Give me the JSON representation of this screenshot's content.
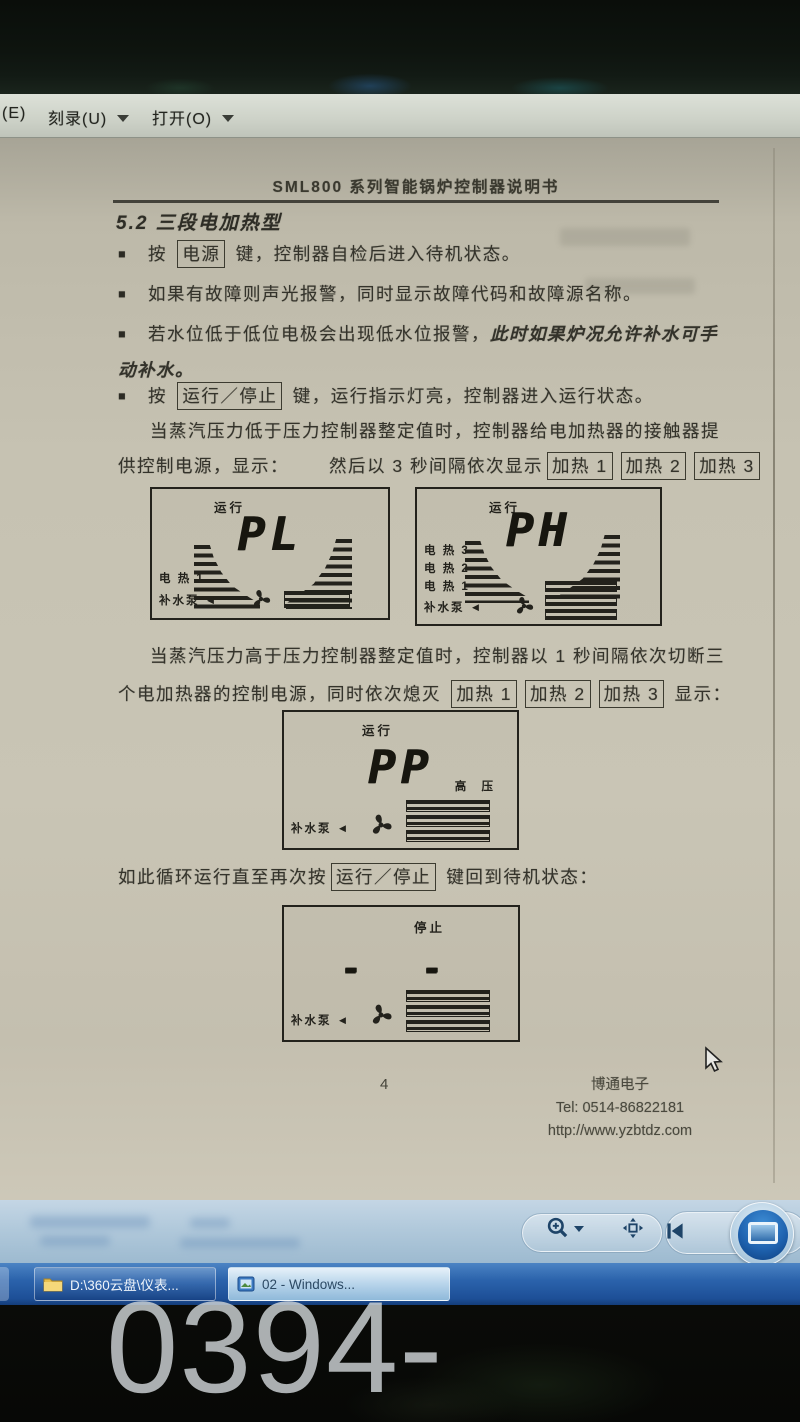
{
  "menu_bar": {
    "partial_item": "(E)",
    "burn_label": "刻录(U)",
    "open_label": "打开(O)"
  },
  "icons": {
    "bullet": "■",
    "chevron_down": "▼",
    "magnifier": "zoom-magnifier-icon",
    "fit_window": "fit-to-window-icon",
    "previous": "previous-image-icon",
    "slideshow": "slideshow-play-icon",
    "fan": "pump-fan-icon",
    "heater": "heater-segment-icon",
    "folder": "folder-icon",
    "photo": "photo-viewer-icon"
  },
  "doc": {
    "header": "SML800 系列智能锅炉控制器说明书",
    "heading": "5.2 三段电加热型",
    "b1_pre": "按 ",
    "key_power": "电源",
    "b1_post": " 键，控制器自检后进入待机状态。",
    "b2": "如果有故障则声光报警，同时显示故障代码和故障源名称。",
    "b3_pre": "若水位低于低位电极会出现低水位报警，",
    "b3_italic": "此时如果炉况允许补水可手",
    "b3_cont": "动补水。",
    "b4_pre": "按 ",
    "key_runstop": "运行／停止",
    "b4_post": " 键，运行指示灯亮，控制器进入运行状态。",
    "p1": "当蒸汽压力低于压力控制器整定值时，控制器给电加热器的接触器提",
    "p2_pre": "供控制电源，显示：",
    "p2_mid": "然后以 3 秒间隔依次显示",
    "key_heat1": "加热 1",
    "key_heat2": "加热 2",
    "key_heat3": "加热 3",
    "p3": "当蒸汽压力高于压力控制器整定值时，控制器以 1 秒间隔依次切断三",
    "p4_pre": "个电加热器的控制电源，同时依次熄灭 ",
    "p4_post": " 显示：",
    "p5_pre": "如此循环运行直至再次按",
    "p5_post": " 键回到待机状态：",
    "panels": {
      "pl": {
        "status": "运行",
        "value": "PL",
        "labels": [
          "电 热 1",
          "补水泵 ◄"
        ]
      },
      "ph": {
        "status": "运行",
        "value": "PH",
        "labels": [
          "电 热 3",
          "电 热 2",
          "电 热 1",
          "补水泵 ◄"
        ]
      },
      "pp": {
        "status": "运行",
        "value": "PP",
        "side_label": "高  压",
        "labels": [
          "补水泵 ◄"
        ]
      },
      "stop": {
        "status": "停止",
        "value": "- -",
        "labels": [
          "补水泵 ◄"
        ]
      }
    },
    "footer": {
      "page_number": "4",
      "company": "博通电子",
      "tel": "Tel: 0514-86822181",
      "url": "http://www.yzbtdz.com"
    }
  },
  "taskbar": {
    "buttons": [
      {
        "label": "D:\\360云盘\\仪表..."
      },
      {
        "label": "02 - Windows..."
      }
    ]
  },
  "watermark": "0394-6792297"
}
